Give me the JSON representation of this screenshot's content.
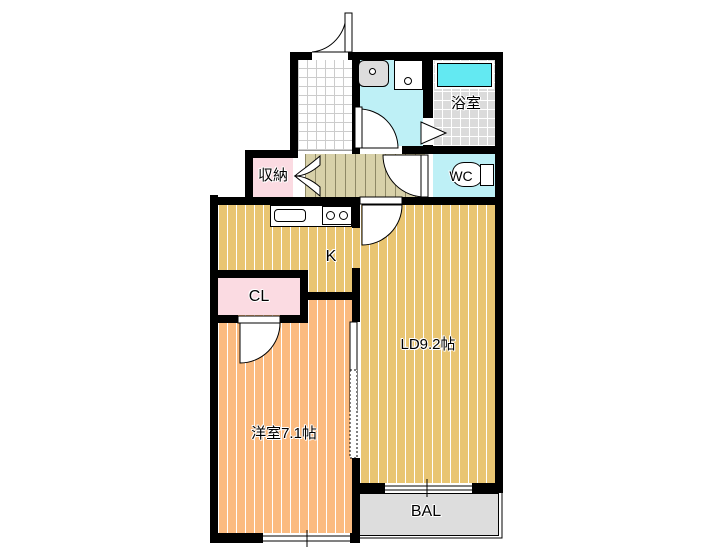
{
  "floorplan": {
    "rooms": {
      "bathroom": {
        "label": "浴室"
      },
      "toilet": {
        "label": "WC"
      },
      "storage": {
        "label": "収納"
      },
      "kitchen": {
        "label": "K"
      },
      "closet": {
        "label": "CL"
      },
      "living_dining": {
        "label": "LD9.2帖"
      },
      "western_room": {
        "label": "洋室7.1帖"
      },
      "balcony": {
        "label": "BAL"
      }
    },
    "fixtures": [
      "bathtub",
      "toilet",
      "vanity-sink",
      "washer-pan",
      "kitchen-sink",
      "stove-burners"
    ],
    "colors": {
      "wall": "#000000",
      "ldk_floor": "#E9C572",
      "western_room_floor": "#FBBB80",
      "closet_pink": "#FBDBE2",
      "wet_area_cyan": "#BEF0F6",
      "bathtub_cyan": "#63E9F2",
      "bath_tile_gray": "#DBDBDB",
      "hallway_beige": "#D8D1A9",
      "balcony_gray": "#DDDDDD"
    }
  }
}
